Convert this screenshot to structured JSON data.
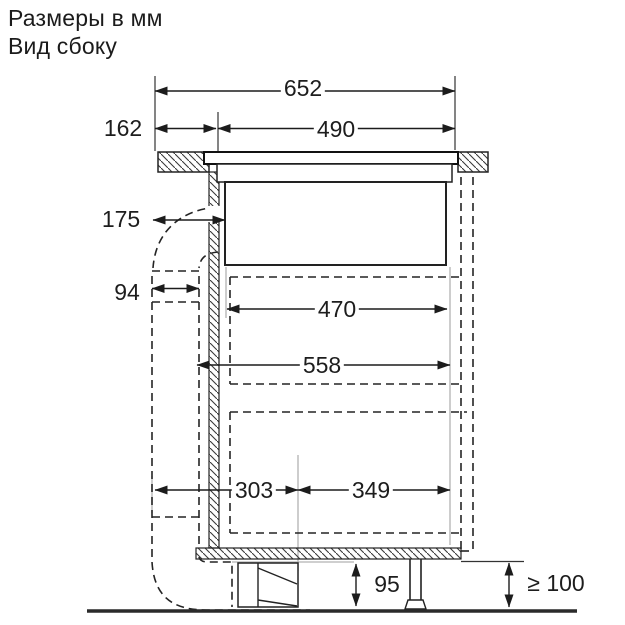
{
  "title": {
    "line1": "Размеры в мм",
    "line2": "Вид сбоку"
  },
  "dimensions": {
    "overall_width": "652",
    "appliance_width": "490",
    "front_overhang": "162",
    "duct_outlet_depth": "175",
    "duct_channel_depth": "94",
    "niche_width": "470",
    "clearance_width": "558",
    "left_span": "303",
    "right_span": "349",
    "plinth_outlet_height": "95",
    "min_floor_clearance": "≥ 100"
  },
  "colors": {
    "line": "#222222",
    "extension_gray": "#b2b2b2",
    "text": "#1d1d1d",
    "background": "#ffffff"
  }
}
